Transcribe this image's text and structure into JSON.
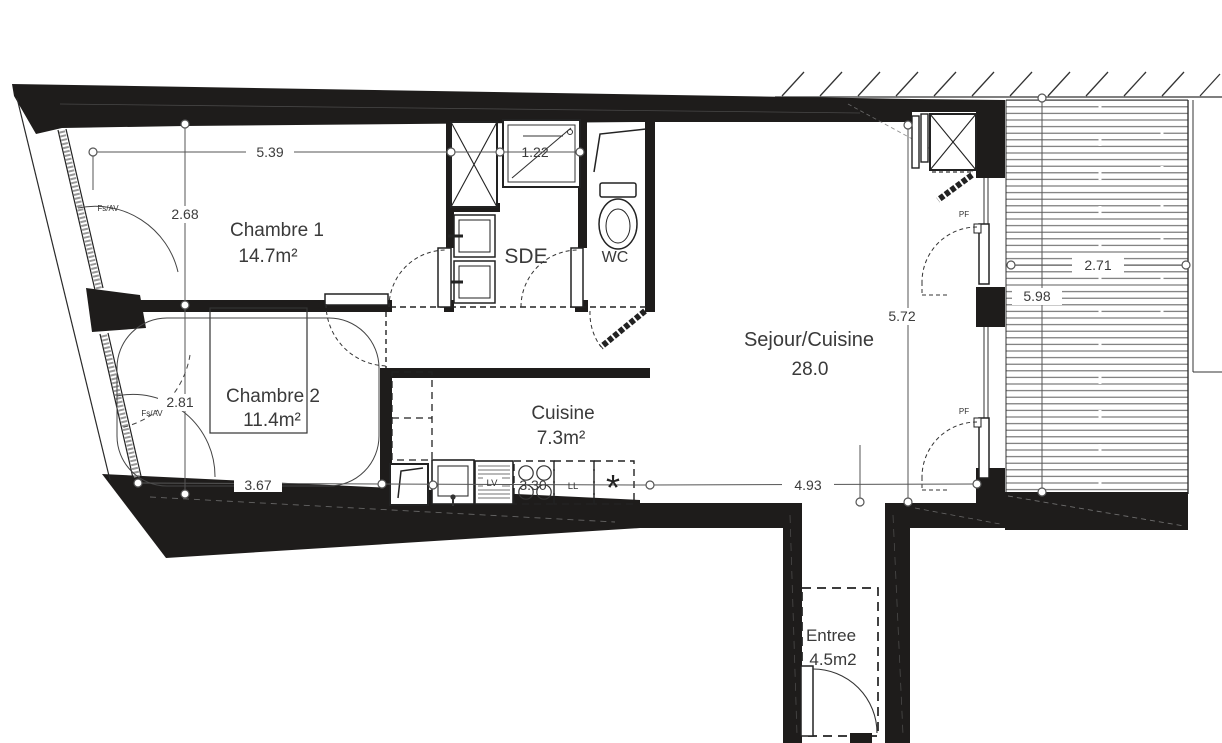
{
  "plan": {
    "type": "apartment-floor-plan",
    "rooms": [
      {
        "id": "chambre1",
        "name": "Chambre 1",
        "area": "14.7m²"
      },
      {
        "id": "chambre2",
        "name": "Chambre 2",
        "area": "11.4m²"
      },
      {
        "id": "sde",
        "name": "SDE",
        "area": ""
      },
      {
        "id": "wc",
        "name": "WC",
        "area": ""
      },
      {
        "id": "cuisine",
        "name": "Cuisine",
        "area": "7.3m²"
      },
      {
        "id": "sejour",
        "name": "Sejour/Cuisine",
        "area": "28.0"
      },
      {
        "id": "entree",
        "name": "Entree",
        "area": "4.5m2"
      }
    ],
    "dimensions_m": {
      "ch1_width": "5.39",
      "ch1_height": "2.68",
      "sde_niche": "1.22",
      "ch2_height": "2.81",
      "ch2_width": "3.67",
      "cuisine_width": "3.30",
      "sejour_width": "4.93",
      "sejour_height": "5.72",
      "balcon_width": "2.71",
      "balcon_height": "5.98"
    },
    "annotations": {
      "window_label": "Fs/AV",
      "french_door_label": "PF",
      "dishwasher": "LV",
      "washer": "LL",
      "star": "*"
    },
    "colors": {
      "wall": "#1e1c1b",
      "dim_line": "#555555",
      "text": "#3a3a3a",
      "deck_slat": "#6a6a6a"
    }
  }
}
